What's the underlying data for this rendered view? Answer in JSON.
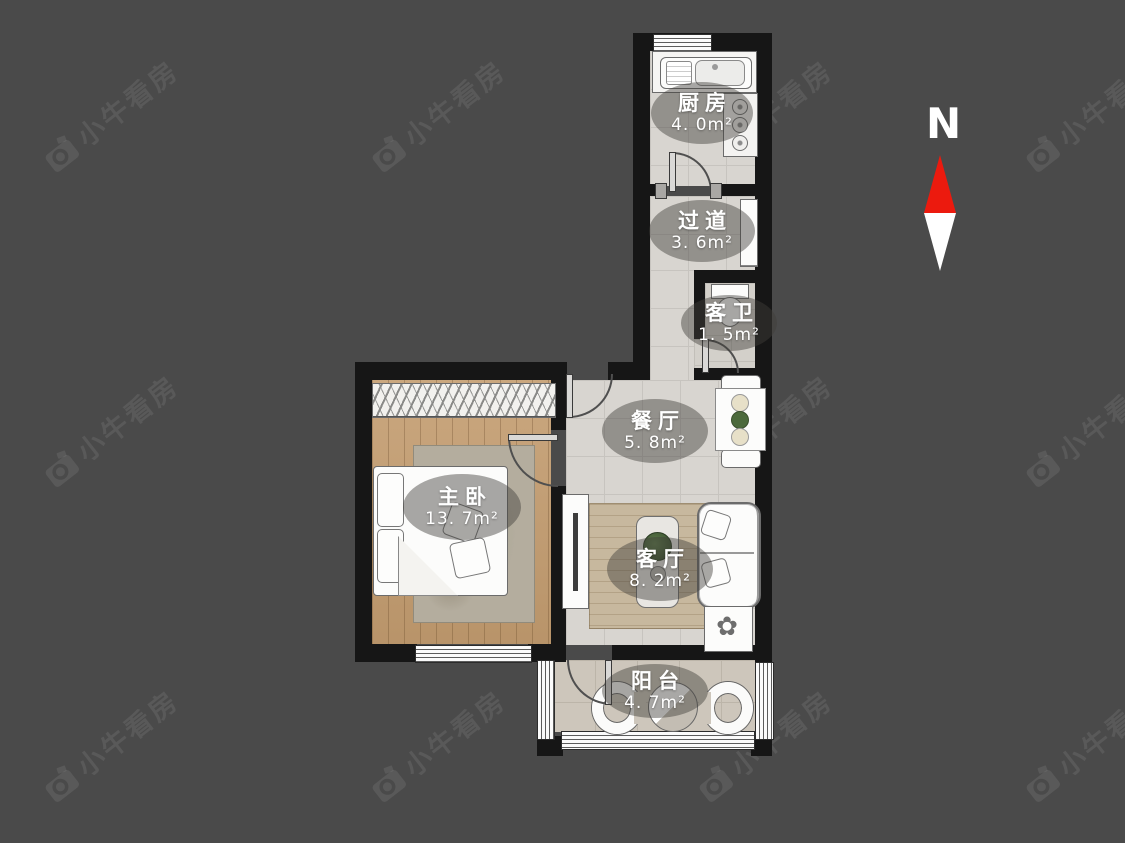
{
  "watermark": {
    "text": "小牛看房",
    "logo": "camera-logo"
  },
  "compass": {
    "label": "N",
    "arrow_up_color": "#ec1a0e",
    "arrow_down_color": "#ffffff"
  },
  "palette": {
    "background": "#4a4a4a",
    "wall": "#161616",
    "tile_floor": "#d8d5d0",
    "wood_floor": "#c49d70",
    "balcony_floor": "#cdc6bb",
    "label_text": "#ffffff"
  },
  "rooms": [
    {
      "id": "kitchen",
      "name": "厨房",
      "area": "4. 0m²"
    },
    {
      "id": "hallway",
      "name": "过道",
      "area": "3. 6m²"
    },
    {
      "id": "guest-bathroom",
      "name": "客卫",
      "area": "1. 5m²"
    },
    {
      "id": "dining-room",
      "name": "餐厅",
      "area": "5. 8m²"
    },
    {
      "id": "master-bedroom",
      "name": "主卧",
      "area": "13. 7m²"
    },
    {
      "id": "living-room",
      "name": "客厅",
      "area": "8. 2m²"
    },
    {
      "id": "balcony",
      "name": "阳台",
      "area": "4. 7m²"
    }
  ]
}
